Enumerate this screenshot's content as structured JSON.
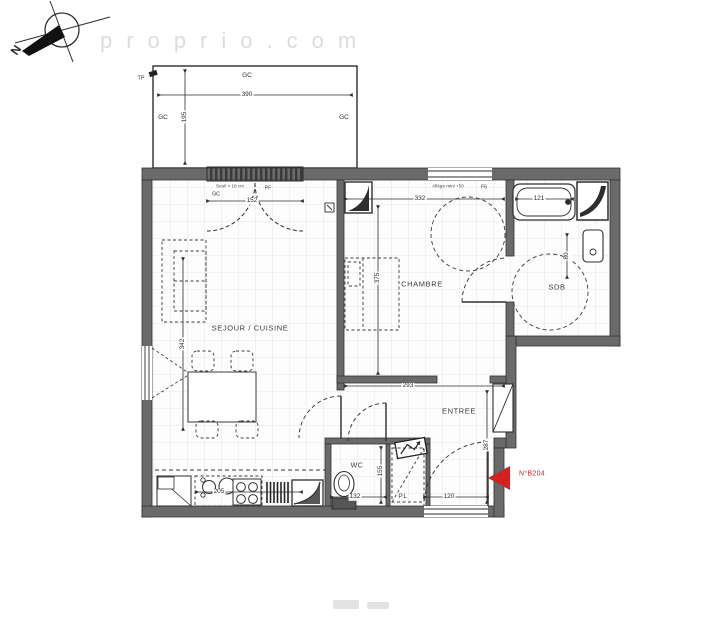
{
  "watermarks": {
    "site": "proprio.com",
    "logo": "EL"
  },
  "compass": {
    "north": "N"
  },
  "rooms": {
    "sejour": "SEJOUR / CUISINE",
    "chambre": "CHAMBRE",
    "sdb": "SDB",
    "entree": "ENTREE",
    "wc": "WC",
    "closet": "PL"
  },
  "dims": {
    "terrace_width": "390",
    "terrace_depth": "195",
    "sejour_window_width": "152",
    "sejour_length": "342",
    "kitchen_run": "205",
    "chambre_width": "332",
    "chambre_depth": "375",
    "tub_length": "121",
    "basin_width": "80",
    "entree_width": "293",
    "entree_depth": "287",
    "entry_door_width": "120",
    "wc_width": "132",
    "wc_depth": "155"
  },
  "labels": {
    "terrace_tp": "TP",
    "gc": "GC",
    "window_pf": "PF",
    "threshold_note": "Seuil < 18 cm",
    "sill_note": "Allège mini +50",
    "window_code": "F6",
    "unit_number": "N°B204"
  },
  "colors": {
    "accent_red": "#d42020",
    "wall_gray": "#6a6a6a"
  }
}
